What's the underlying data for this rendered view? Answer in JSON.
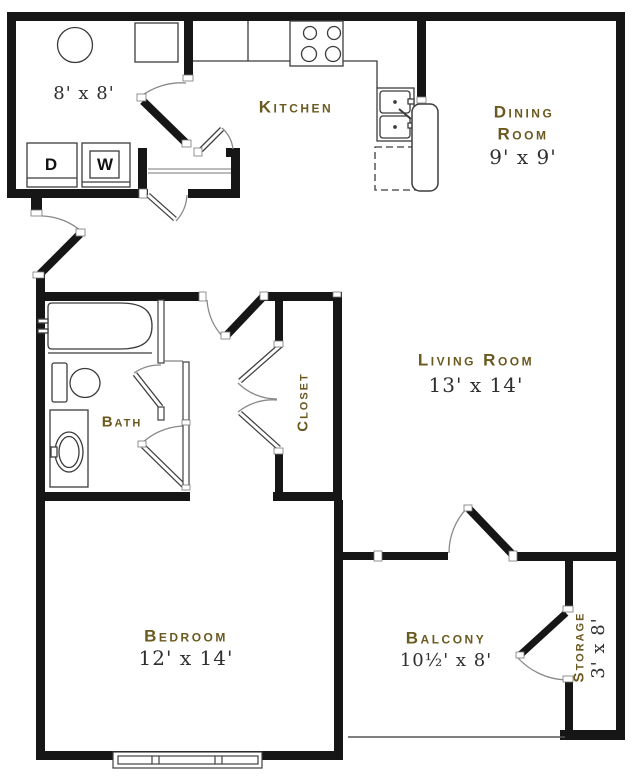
{
  "title": "One Bedroom Floor Plan",
  "colors": {
    "room_label": "#6b5a20",
    "dimension_text": "#2f2f2f",
    "walls": "#161616"
  },
  "rooms": {
    "laundry": {
      "dims": "8' x 8'"
    },
    "kitchen": {
      "name": "Kitchen"
    },
    "dining": {
      "name_line1": "Dining",
      "name_line2": "Room",
      "dims": "9' x 9'"
    },
    "living": {
      "name": "Living Room",
      "dims": "13' x 14'"
    },
    "bath": {
      "name": "Bath"
    },
    "closet": {
      "name": "Closet"
    },
    "bedroom": {
      "name": "Bedroom",
      "dims": "12' x 14'"
    },
    "balcony": {
      "name": "Balcony",
      "dims": "10½' x 8'"
    },
    "storage": {
      "name": "Storage",
      "dims": "3' x 8'"
    }
  },
  "appliances": {
    "dryer": "D",
    "washer": "W"
  }
}
